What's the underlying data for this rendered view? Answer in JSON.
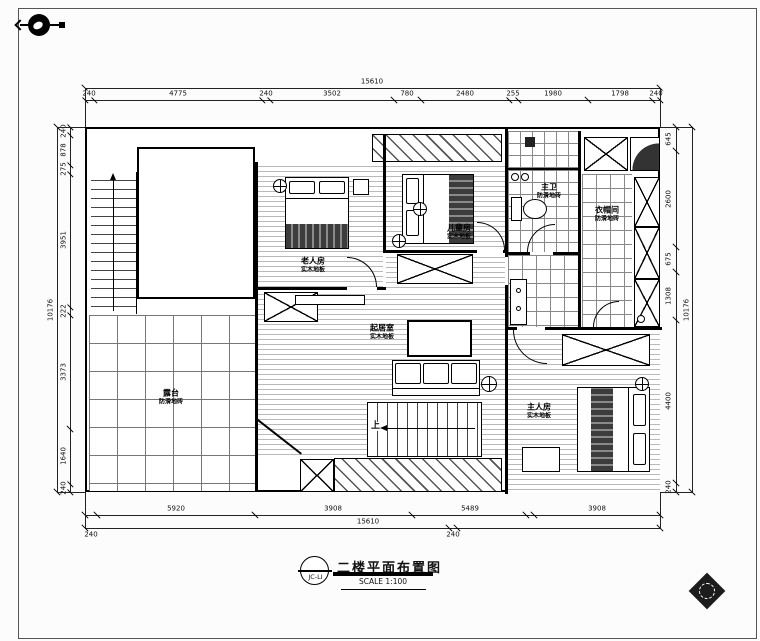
{
  "dims": {
    "top": {
      "overall": "15610",
      "segments": [
        "240",
        "4775",
        "240",
        "3502",
        "780",
        "2480",
        "255",
        "1980",
        "1798",
        "240"
      ]
    },
    "left": {
      "overall": "10176",
      "segments": [
        "240",
        "878",
        "275",
        "3951",
        "222",
        "3373",
        "1640",
        "240"
      ]
    },
    "right": {
      "overall": "10176",
      "segments": [
        "645",
        "2600",
        "675",
        "1308",
        "4400",
        "240"
      ]
    },
    "bottom": {
      "row1": [
        "5920",
        "3908",
        "5489",
        "3908"
      ],
      "row2": [
        "240",
        "15610",
        "240"
      ]
    }
  },
  "rooms": {
    "terrace": {
      "name": "露台",
      "floor": "防滑地砖"
    },
    "bedroom_a": {
      "name": "老人房",
      "floor": "实木地板"
    },
    "bedroom_b": {
      "name": "儿童房",
      "floor": "实木地板"
    },
    "living": {
      "name": "起居室",
      "floor": "实木地板"
    },
    "master": {
      "name": "主人房",
      "floor": "实木地板"
    },
    "bath": {
      "name": "主卫",
      "floor": "防滑地砖"
    },
    "utility": {
      "name": "衣帽间",
      "floor": "防滑地砖"
    }
  },
  "plan": {
    "stairs_up": "上"
  },
  "title_block": {
    "tag": "JC-LI",
    "title": "二楼平面布置图",
    "scale": "SCALE 1:100"
  }
}
